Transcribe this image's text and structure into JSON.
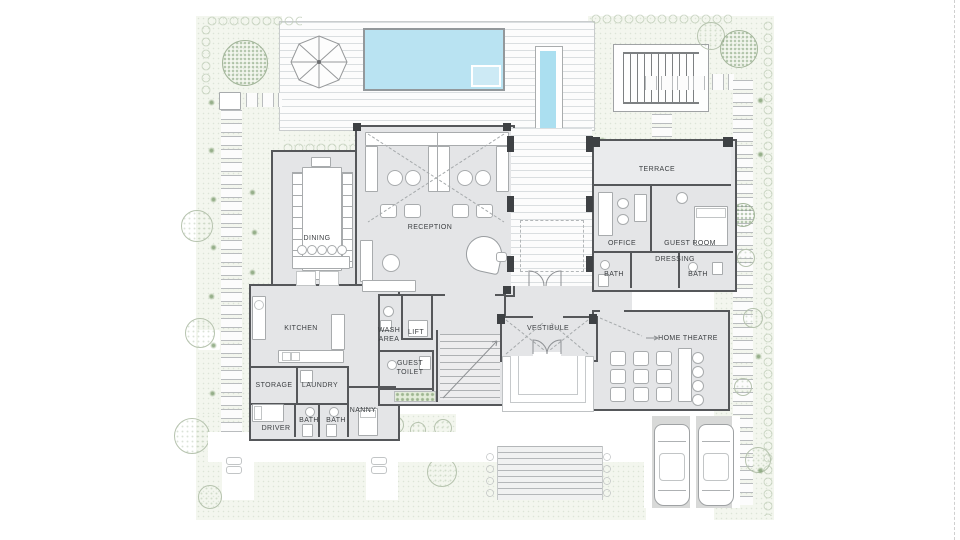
{
  "plan": {
    "rooms": {
      "dining": "DINING",
      "reception": "RECEPTION",
      "terrace": "TERRACE",
      "office": "OFFICE",
      "guest_room": "GUEST ROOM",
      "dressing": "DRESSING",
      "bath_office": "BATH",
      "bath_guest": "BATH",
      "kitchen": "KITCHEN",
      "wash_area": "WASH AREA",
      "lift": "LIFT",
      "guest_toilet": "GUEST TOILET",
      "storage": "STORAGE",
      "laundry": "LAUNDRY",
      "nanny": "NANNY",
      "driver": "DRIVER",
      "bath_service_1": "BATH",
      "bath_service_2": "BATH",
      "vestibule": "VESTIBULE",
      "home_theatre": "HOME THEATRE"
    }
  },
  "colors": {
    "pool_water": "#b9e3f2",
    "water_feature": "#abdff0",
    "floor": "#e4e5e7",
    "wall": "#55575a",
    "garden": "#f3f6ee",
    "deck": "#fcfcfc",
    "driveway": "#d8d9d8"
  }
}
